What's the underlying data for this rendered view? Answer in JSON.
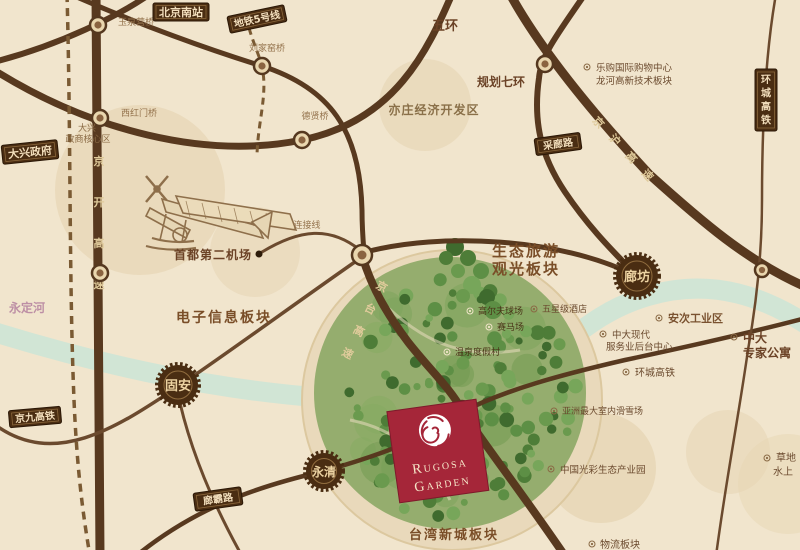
{
  "brand": {
    "line1": "Rugosa",
    "line2": "Garden"
  },
  "colors": {
    "background": "#f1e5cd",
    "road": "#58391f",
    "badge_bg": "#4a2d12",
    "badge_text": "#f2debc",
    "accent_red": "#a52639",
    "river": "#cde4d6",
    "forest_green": "#8fa969",
    "label_brown": "#7a4e28",
    "river_label_pink": "#bd8fa5"
  },
  "ring_roads": {
    "wuhuan": "五环",
    "qihuan": "规划七环"
  },
  "expressways": {
    "jingkai": "京开高速",
    "jingtai": "京台高速",
    "jinghu": "京沪高速"
  },
  "railways": {
    "metro5": "地铁5号线",
    "jingjiu": "京九高铁",
    "huancheng": "环城高铁"
  },
  "station": {
    "beijing_south": "北京南站"
  },
  "badges": {
    "daxing_gov": "大兴政府",
    "cailang_road": "采廊路",
    "langba_road": "廊霸路"
  },
  "bridges": {
    "yuquanying": "玉泉营桥",
    "liujiayao": "刘家窑桥",
    "xihongmen": "西红门桥",
    "dexian": "德贤桥",
    "connector": "连接线"
  },
  "cities": {
    "langfang": "廊坊",
    "guan": "固安",
    "yongqing": "永清"
  },
  "areas": {
    "daxing_core": {
      "line1": "大兴",
      "line2": "政商核心区"
    },
    "yizhuang": "亦庄经济开发区",
    "airport": "首都第二机场",
    "dianzi": "电子信息板块",
    "shengtai": {
      "line1": "生态旅游",
      "line2": "观光板块"
    },
    "taiwan": "台湾新城板块",
    "yongdinghe": "永定河"
  },
  "pois": {
    "legou": {
      "line1": "乐购国际购物中心",
      "line2": "龙河高新技术板块"
    },
    "anci": "安次工业区",
    "zhongda_houtai": {
      "line1": "中大现代",
      "line2": "服务业后台中心"
    },
    "zhongda_apartment": {
      "line1": "中大",
      "line2": "专家公寓"
    },
    "huancheng_rail": "环城高铁",
    "golf": "高尔夫球场",
    "racecourse": "赛马场",
    "hotel": "五星级酒店",
    "hot_spring": "温泉度假村",
    "ski": "亚洲最大室内滑雪场",
    "guangcai": "中国光彩生态产业园",
    "grass": {
      "line1": "草地",
      "line2": "水上"
    },
    "wuliu": "物流板块"
  }
}
